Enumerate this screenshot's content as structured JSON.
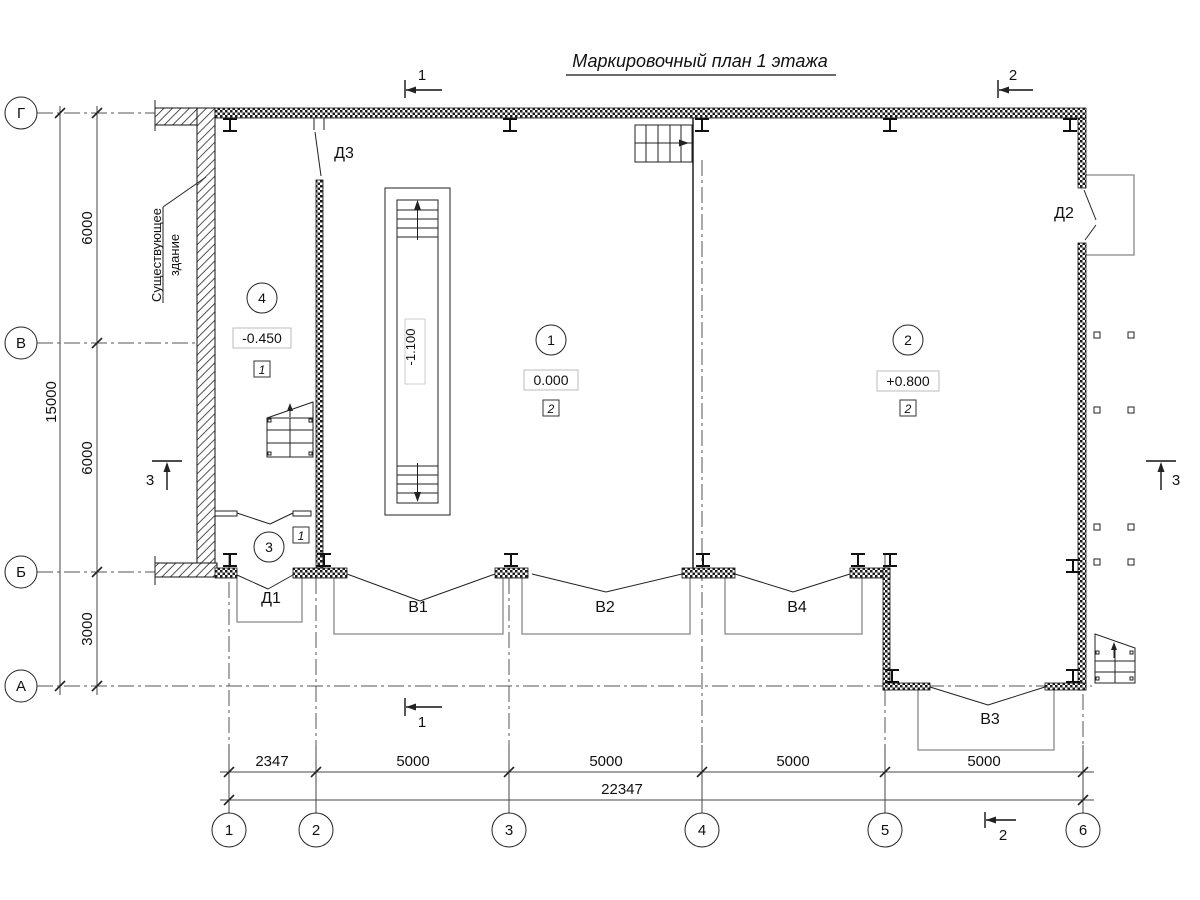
{
  "title": "Маркировочный план 1 этажа",
  "axes": {
    "rows": [
      "Г",
      "В",
      "Б",
      "А"
    ],
    "cols": [
      "1",
      "2",
      "3",
      "4",
      "5",
      "6"
    ]
  },
  "dimensions": {
    "left_total": "15000",
    "left_segments": [
      "6000",
      "6000",
      "3000"
    ],
    "bottom_segments": [
      "2347",
      "5000",
      "5000",
      "5000",
      "5000"
    ],
    "bottom_total": "22347"
  },
  "rooms": [
    {
      "number": "4",
      "elevation": "-0.450",
      "finish_type": "1"
    },
    {
      "number": "1",
      "elevation": "0.000",
      "finish_type": "2"
    },
    {
      "number": "2",
      "elevation": "+0.800",
      "finish_type": "2"
    },
    {
      "number": "3",
      "finish_type": "1"
    }
  ],
  "stair": {
    "elevation": "-1.100"
  },
  "openings": {
    "d1": "Д1",
    "d2": "Д2",
    "d3": "Д3",
    "v1": "В1",
    "v2": "В2",
    "v3": "В3",
    "v4": "В4"
  },
  "sections": {
    "s1": "1",
    "s2": "2",
    "s3": "3"
  },
  "notes": {
    "existing_building": [
      "Существующее",
      "здание"
    ]
  }
}
